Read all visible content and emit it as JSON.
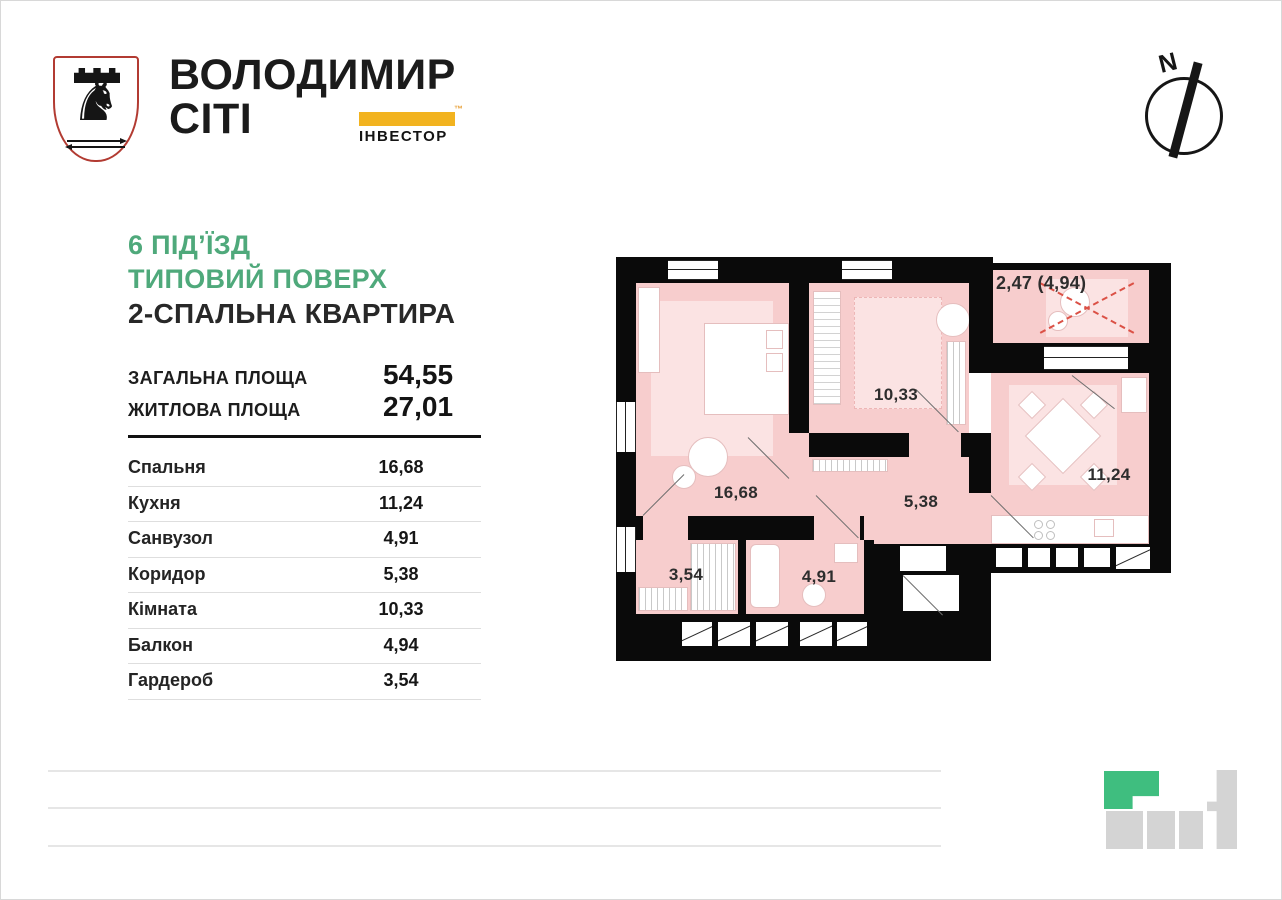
{
  "brand": {
    "name_line1": "ВОЛОДИМИР",
    "name_line2": "СІТІ",
    "badge_label": "ІНВЕСТОР",
    "trademark": "™",
    "badge_color": "#F2B31F"
  },
  "compass": {
    "label": "N"
  },
  "title": {
    "line1": "6 ПІД’ЇЗД",
    "line2": "ТИПОВИЙ ПОВЕРХ",
    "line3": "2-СПАЛЬНА КВАРТИРА",
    "accent_color": "#4FA97B"
  },
  "summary": {
    "rows": [
      {
        "label": "ЗАГАЛЬНА ПЛОЩА",
        "value": "54,55"
      },
      {
        "label": "ЖИТЛОВА ПЛОЩА",
        "value": "27,01"
      }
    ]
  },
  "rooms": [
    {
      "label": "Спальня",
      "value": "16,68"
    },
    {
      "label": "Кухня",
      "value": "11,24"
    },
    {
      "label": "Санвузол",
      "value": "4,91"
    },
    {
      "label": "Коридор",
      "value": "5,38"
    },
    {
      "label": "Кімната",
      "value": "10,33"
    },
    {
      "label": "Балкон",
      "value": "4,94"
    },
    {
      "label": "Гардероб",
      "value": "3,54"
    }
  ],
  "plan": {
    "labels": {
      "bedroom": "16,68",
      "living_room": "10,33",
      "balcony": "2,47 (4,94)",
      "kitchen": "11,24",
      "corridor": "5,38",
      "wardrobe": "3,54",
      "bathroom": "4,91"
    },
    "colors": {
      "wall": "#0A0A0A",
      "floor": "#F7CDCD",
      "rug": "#FBE3E3",
      "balcony_marking": "#DB5146"
    }
  }
}
